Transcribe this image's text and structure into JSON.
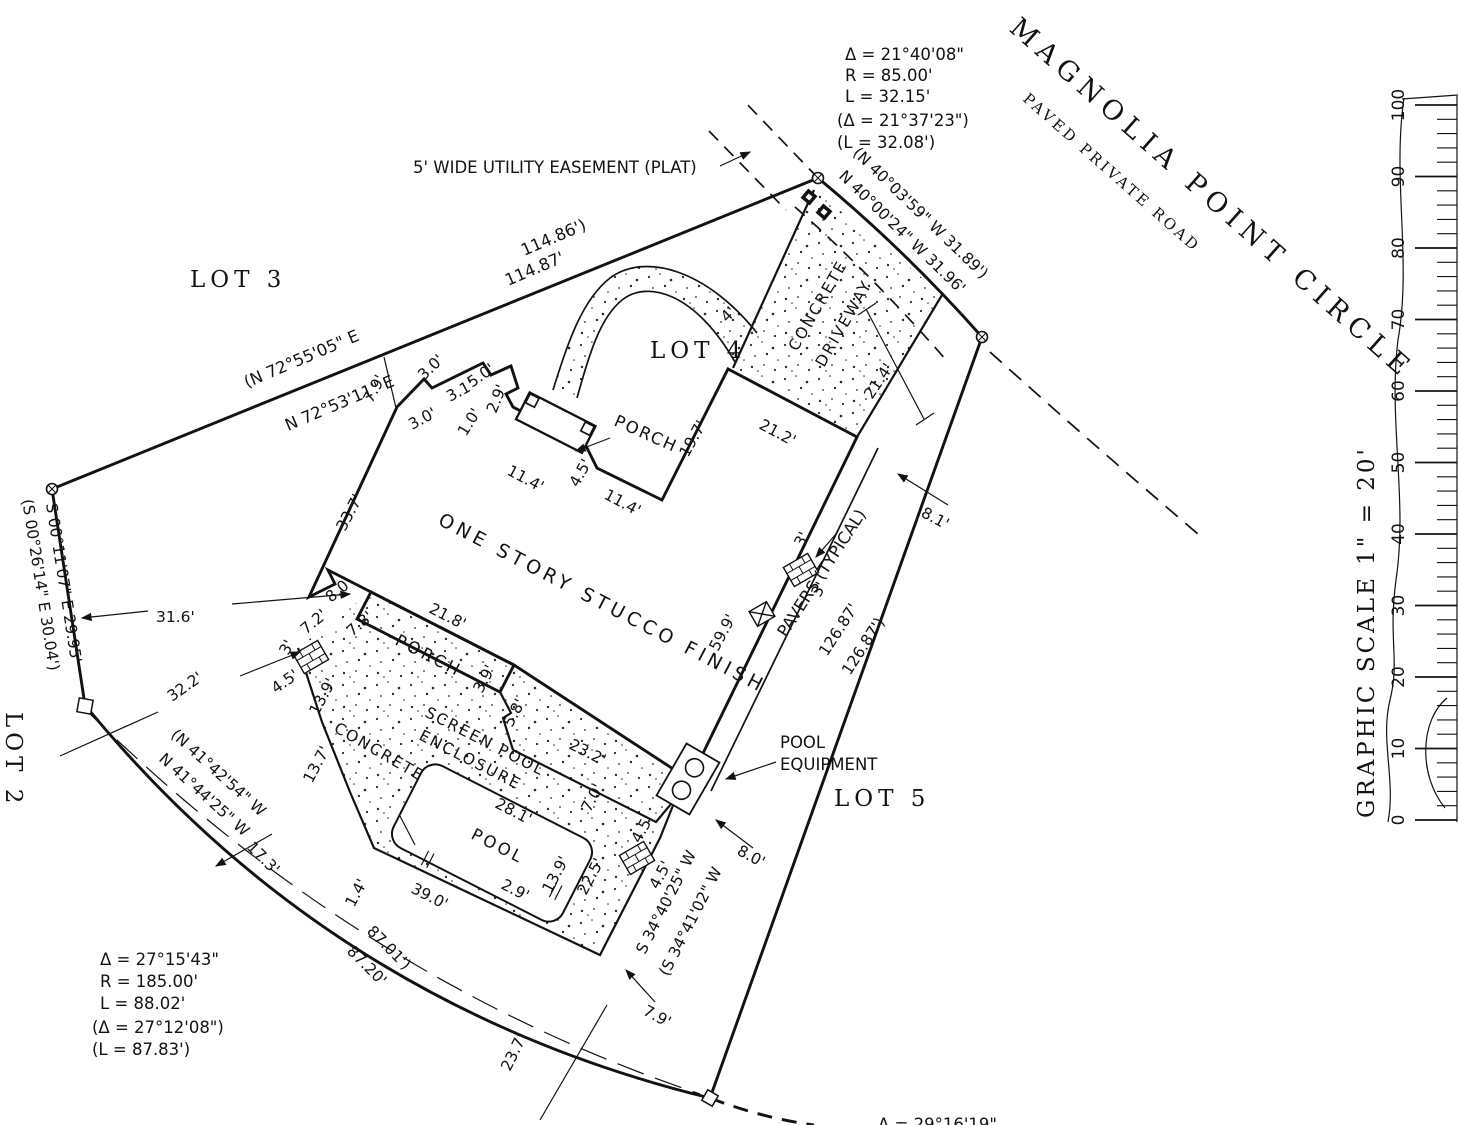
{
  "road": {
    "name": "MAGNOLIA POINT CIRCLE",
    "subtitle": "PAVED PRIVATE ROAD"
  },
  "lots": {
    "lot2": "LOT 2",
    "lot3": "LOT 3",
    "lot4": "LOT 4",
    "lot5": "LOT 5"
  },
  "easement": {
    "label": "5' WIDE UTILITY EASEMENT (PLAT)"
  },
  "curve_top": {
    "delta": "Δ = 21°40'08\"",
    "radius": "R = 85.00'",
    "length": "L = 32.15'",
    "delta_plat": "(Δ = 21°37'23\")",
    "length_plat": "(L = 32.08')"
  },
  "curve_bottom": {
    "delta": "Δ = 27°15'43\"",
    "radius": "R = 185.00'",
    "length": "L = 88.02'",
    "delta_plat": "(Δ = 27°12'08\")",
    "length_plat": "(L = 87.83')"
  },
  "curve_bottom_right": {
    "delta": "Δ = 29°16'19\""
  },
  "bearings": {
    "north_plat": "(N 72°55'05\" E",
    "north_meas": "N 72°53'11\" E",
    "north_dist_plat": "114.86')",
    "north_dist_meas": "114.87'",
    "west_meas": "S 00°11'07\" E 29.95'",
    "west_plat": "(S 00°26'14\" E 30.04')",
    "road_plat": "(N 40°03'59\" W  31.89')",
    "road_meas": "N 40°00'24\" W  31.96'",
    "se_meas": "S 34°40'25\" W",
    "se_plat": "(S 34°41'02\" W",
    "sw_chord_plat": "(N 41°42'54\" W",
    "sw_chord_meas": "N 41°44'25\" W",
    "sw_dist_plat": "87.01')",
    "sw_dist_meas": "87.20'"
  },
  "labels": {
    "house": "ONE STORY STUCCO FINISH",
    "entry_porch": "PORCH",
    "rear_porch": "PORCH",
    "pool": "POOL",
    "pool_equip_1": "POOL",
    "pool_equip_2": "EQUIPMENT",
    "screen_1": "SCREEN POOL",
    "screen_2": "ENCLOSURE",
    "concrete": "CONCRETE",
    "drive_1": "CONCRETE",
    "drive_2": "DRIVEWAY",
    "pavers": "PAVERS (TYPICAL)"
  },
  "dims": {
    "nw_setback": "7.9'",
    "jog_a": "3.0'",
    "jog_b": "3.1'",
    "jog_c": "3.0'",
    "jog_d": "5.0'",
    "jog_e": "2.9'",
    "jog_f": "1.0'",
    "front_a": "11.4'",
    "front_step": "4.5'",
    "front_b": "11.4'",
    "garage_side": "19.7'",
    "garage_front": "21.2'",
    "drive_width": "21.4'",
    "walk_width": "4'",
    "sw_wall": "33.7'",
    "se_wall": "59.9'",
    "walk_gap": "8.1'",
    "pv1_a": "3'",
    "pv1_b": "3'",
    "boundary_se_meas": "126.87'",
    "boundary_se_plat": "126.87')",
    "rear_jog_a": "7.2'",
    "rear_jog_b": "8.0'",
    "rear_jog_c": "7.8'",
    "rear_porch_len": "21.8'",
    "rear_porch_a": "3.9'",
    "rear_porch_b": "5.8'",
    "pv2_a": "3'",
    "pv2_b": "4.5'",
    "deck_a": "13.9'",
    "deck_b": "13.7'",
    "encl_ne": "23.2'",
    "encl_jog": "7.0'",
    "pool_len": "28.1'",
    "pool_w": "13.9'",
    "pool_jog": "2.9'",
    "encl_se": "22.5'",
    "encl_bottom": "39.0'",
    "pool_step": "1.4'",
    "pv3_a": "4.5'",
    "pv3_b": "4.5'",
    "se_gap": "8.0'",
    "se_gap2": "7.9'",
    "bottom_gap": "23.7'",
    "west_gap": "17.3'",
    "w_dim_a": "31.6'",
    "w_dim_b": "32.2'"
  },
  "scale": {
    "label": "GRAPHIC SCALE 1\" = 20'",
    "ticks": [
      "0",
      "10",
      "20",
      "30",
      "40",
      "50",
      "60",
      "70",
      "80",
      "90",
      "100"
    ]
  }
}
